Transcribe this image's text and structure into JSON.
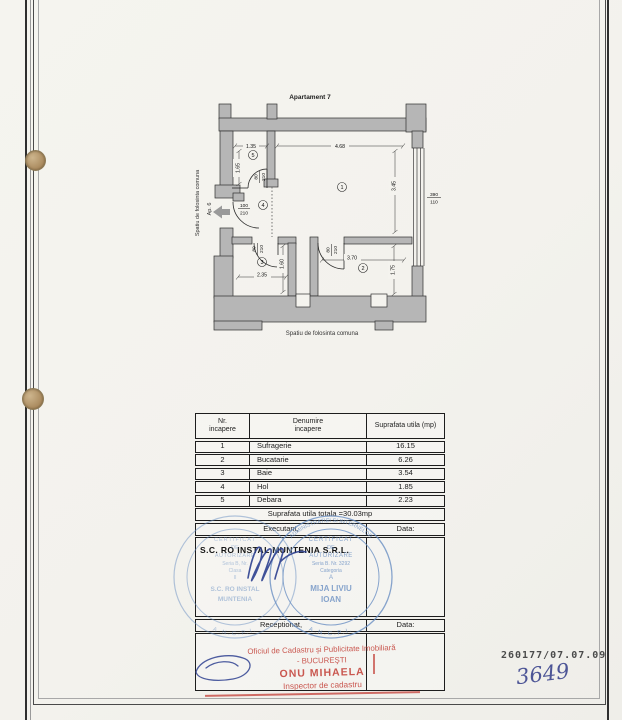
{
  "plan": {
    "title": "Apartament 7",
    "rooms": {
      "r1": "1",
      "r2": "2",
      "r3": "3",
      "r4": "4",
      "r5": "5"
    },
    "dims": {
      "w_debara": "1.35",
      "w_suf": "4.68",
      "h_debara": "1.65",
      "h_suf": "3.45",
      "w_baie": "2.35",
      "h_baie": "1.60",
      "w_buc": "3.70",
      "h_buc": "1.75"
    },
    "openings": {
      "door_small_w": "80",
      "door_main_w": "100",
      "door_h": "210",
      "win_w": "390",
      "win_h": "110"
    },
    "labels": {
      "common_left": "Spatiu de folosinta comuna",
      "ap6": "Ap. 6",
      "common_bottom": "Spatiu de folosinta comuna"
    }
  },
  "table": {
    "header": {
      "col1_l1": "Nr.",
      "col1_l2": "incapere",
      "col2_l1": "Denumire",
      "col2_l2": "incapere",
      "col3": "Suprafata utila (mp)"
    },
    "rows": [
      [
        "1",
        "Sufragerie",
        "16.15"
      ],
      [
        "2",
        "Bucatarie",
        "6.26"
      ],
      [
        "3",
        "Baie",
        "3.54"
      ],
      [
        "4",
        "Hol",
        "1.85"
      ],
      [
        "5",
        "Debara",
        "2.23"
      ]
    ],
    "total": "Suprafata utila totala =30.03mp",
    "executant": "Executant,",
    "data1": "Data:",
    "company": "S.C. RO INSTAL MUNTENIA  S.R.L.",
    "receptionat": "Receptionat,",
    "data2": "Data:"
  },
  "stamps": {
    "blue_right": {
      "l1": "CERTIFICAT",
      "l2": "DE",
      "l3": "AUTORIZARE",
      "l4": "Seria B. Nr. 3292",
      "l5": "Categoria",
      "l6": "A",
      "l7": "MIJA LIVIU",
      "l8": "IOAN",
      "ring_top": "ADMINISTRATIEI SI INTERNELOR",
      "ring_bottom": "A.N.C.P.I."
    },
    "blue_left": {
      "l1": "CERTIFICAT",
      "l2": "DE",
      "l3": "AUTORIZARE",
      "l4": "Seria B, Nr.",
      "l5": "Clasa",
      "l6": "II",
      "l7": "S.C. RO INSTAL",
      "l8": "MUNTENIA",
      "ring_bottom": "A.N.C.P.I."
    },
    "red": {
      "l1": "Oficiul de Cadastru şi Publicitate Imobiliară",
      "l2": "- BUCUREŞTI",
      "l3": "ONU MIHAELA",
      "l4": "Inspector de cadastru"
    },
    "registration": "260177/07.07.09",
    "handwritten": "3649"
  }
}
